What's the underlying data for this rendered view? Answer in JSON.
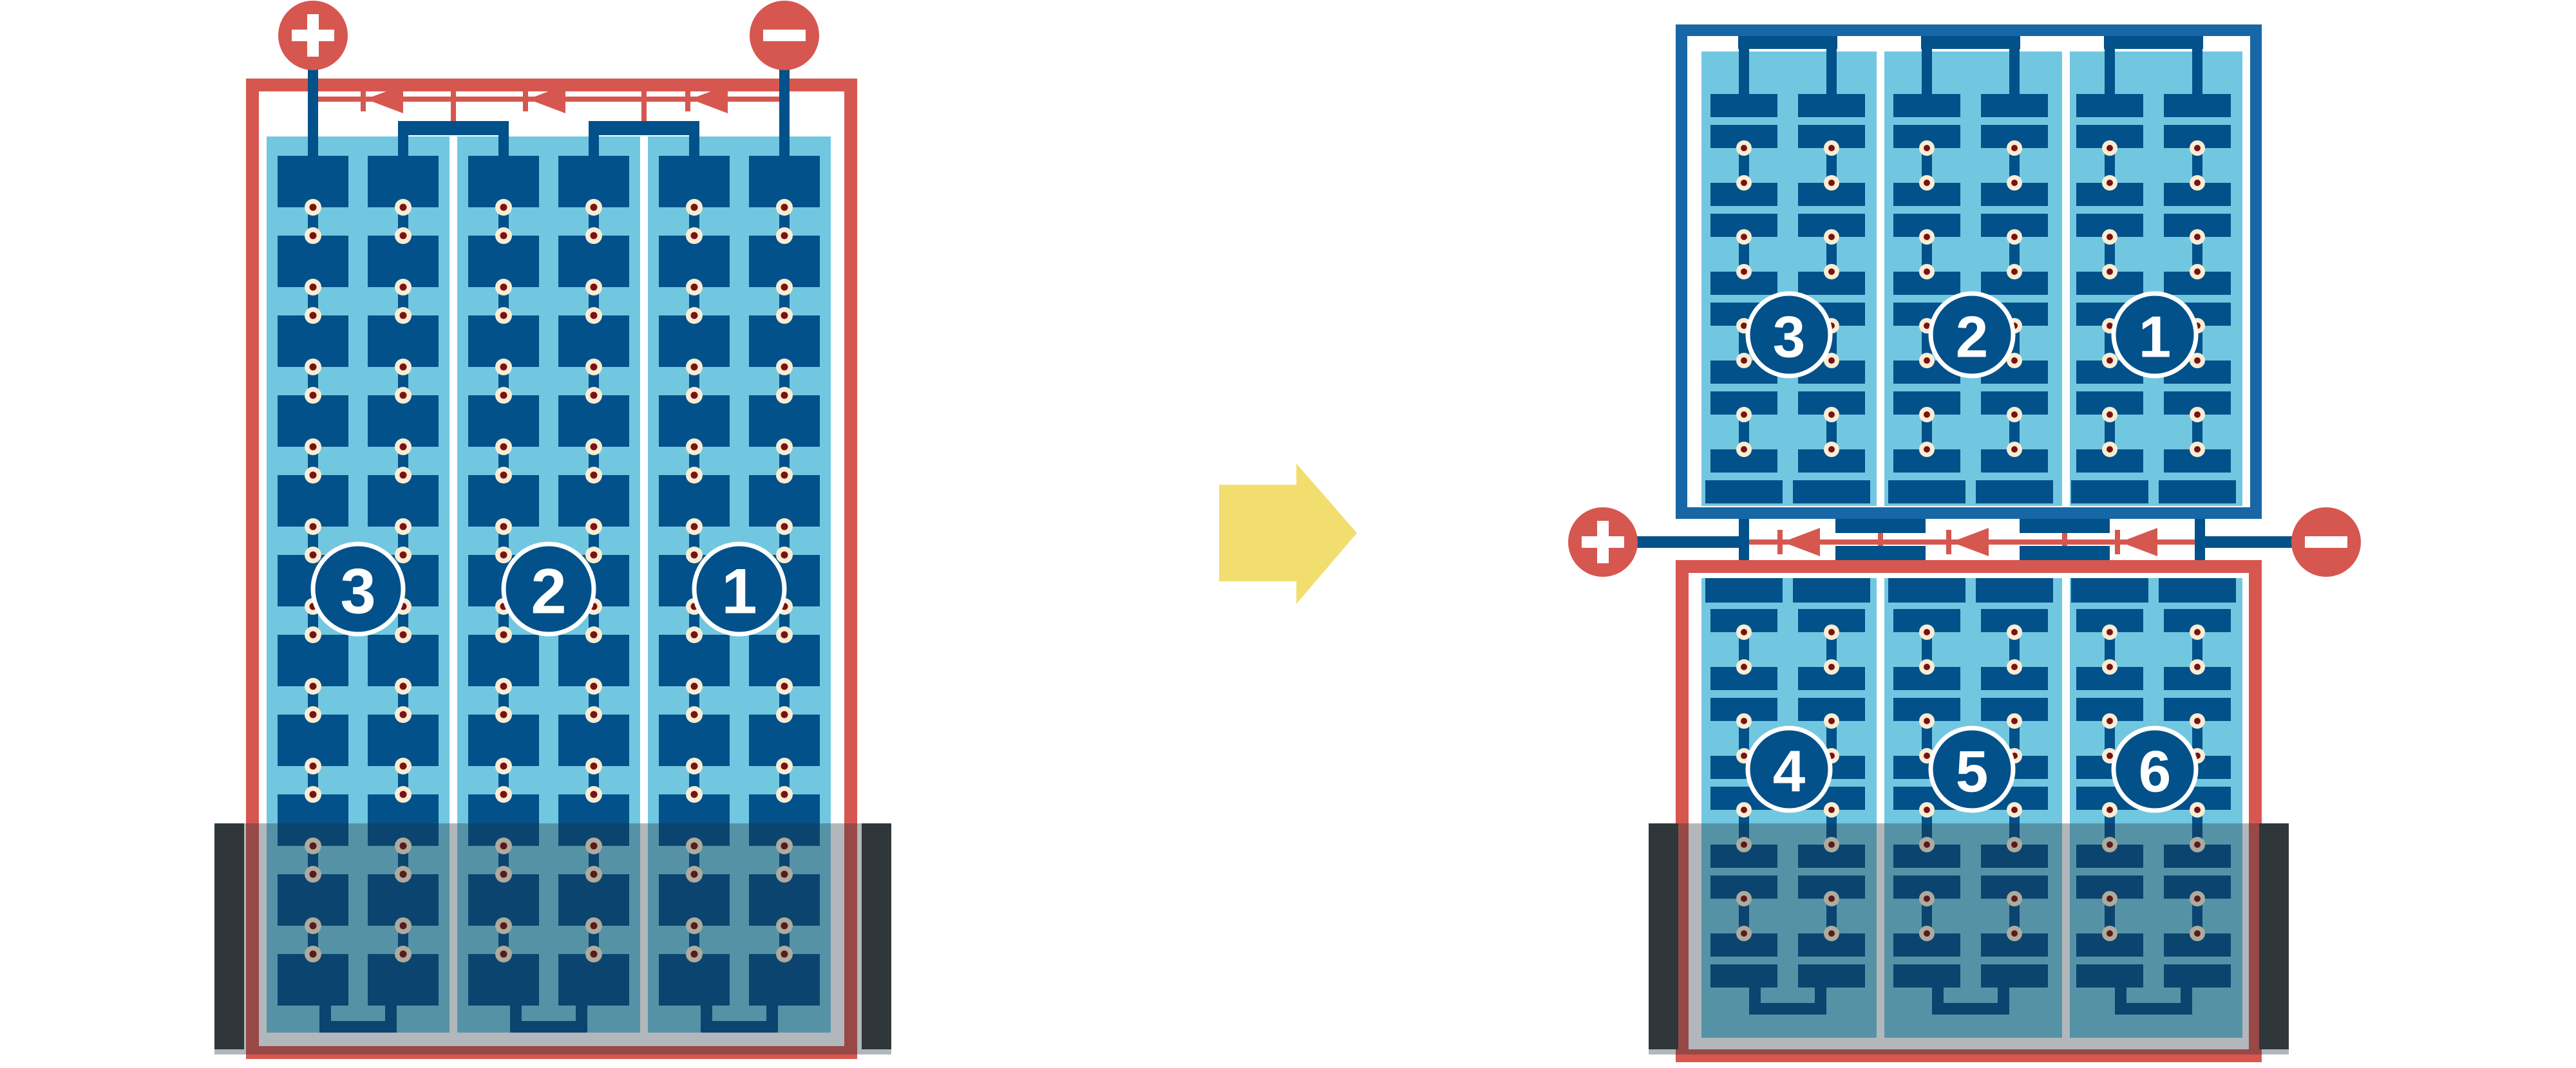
{
  "colors": {
    "red": "#D6574F",
    "module_frame_blue": "#1767A6",
    "cell_navy": "#02518A",
    "panel_sky": "#72C7E0",
    "solder_cream": "#F8EDD4",
    "solder_red": "#7B1212",
    "arrow_yellow": "#F2DE6E",
    "shade_bar_dark": "#3A3D3D",
    "shade_overlay": "rgba(30,45,55,0.34)",
    "label_text": "#FFFFFF",
    "background": "#FFFFFF"
  },
  "left_module": {
    "string_labels": [
      "3",
      "2",
      "1"
    ],
    "string_count": 3,
    "cell_columns_per_string": 2,
    "cell_rows": 11,
    "bypass_diode_count": 3,
    "terminals": {
      "positive": "+",
      "negative": "−"
    }
  },
  "right_top_module": {
    "string_labels": [
      "3",
      "2",
      "1"
    ],
    "string_count": 3,
    "cell_columns_per_string": 2,
    "cell_rows": 10
  },
  "right_bottom_module": {
    "string_labels": [
      "4",
      "5",
      "6"
    ],
    "string_count": 3,
    "cell_columns_per_string": 2,
    "cell_rows": 10
  },
  "junction": {
    "bypass_diode_count": 3,
    "terminals": {
      "positive": "+",
      "negative": "−"
    }
  },
  "transform_arrow": {
    "direction": "right"
  }
}
